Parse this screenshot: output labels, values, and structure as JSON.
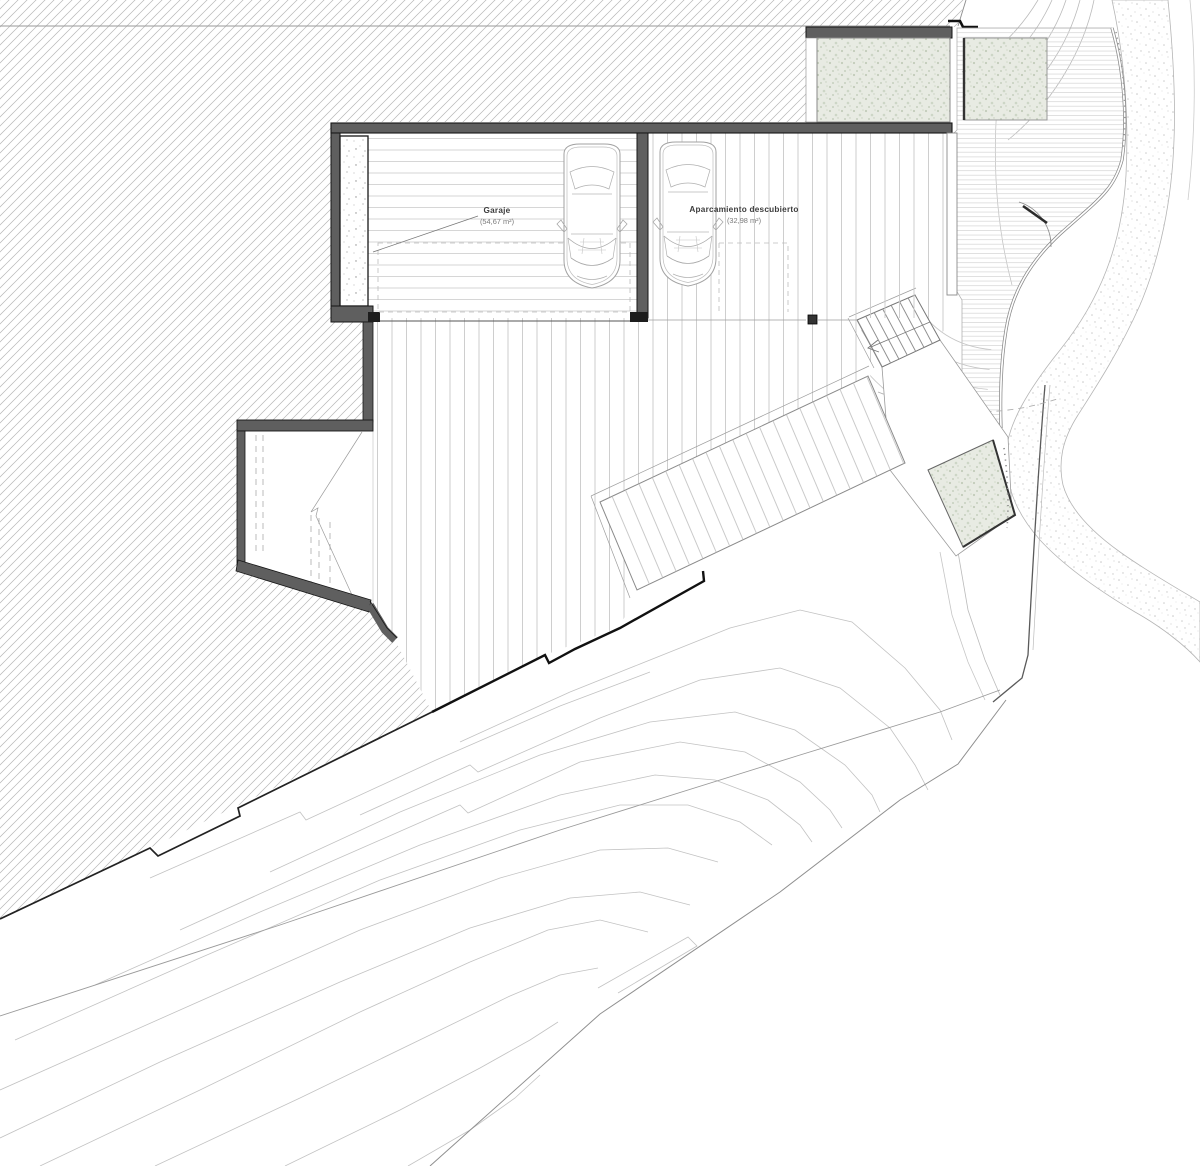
{
  "plan": {
    "spaces": [
      {
        "label": "Garaje",
        "area": "(54,67 m²)"
      },
      {
        "label": "Aparcamiento descubierto",
        "area": "(32,98 m²)"
      }
    ],
    "colors": {
      "wall_fill": "#5f5f5f",
      "wall_edge": "#161616",
      "planter_fill": "#e8ebe3",
      "planter_dot": "#c2ccba",
      "hatch_line": "#b6b6b6",
      "deck_stripe": "#c9c9c9",
      "contour_line": "#c2c2c2",
      "label_text": "#3c3c3c",
      "area_text": "#7a7a7a"
    }
  }
}
